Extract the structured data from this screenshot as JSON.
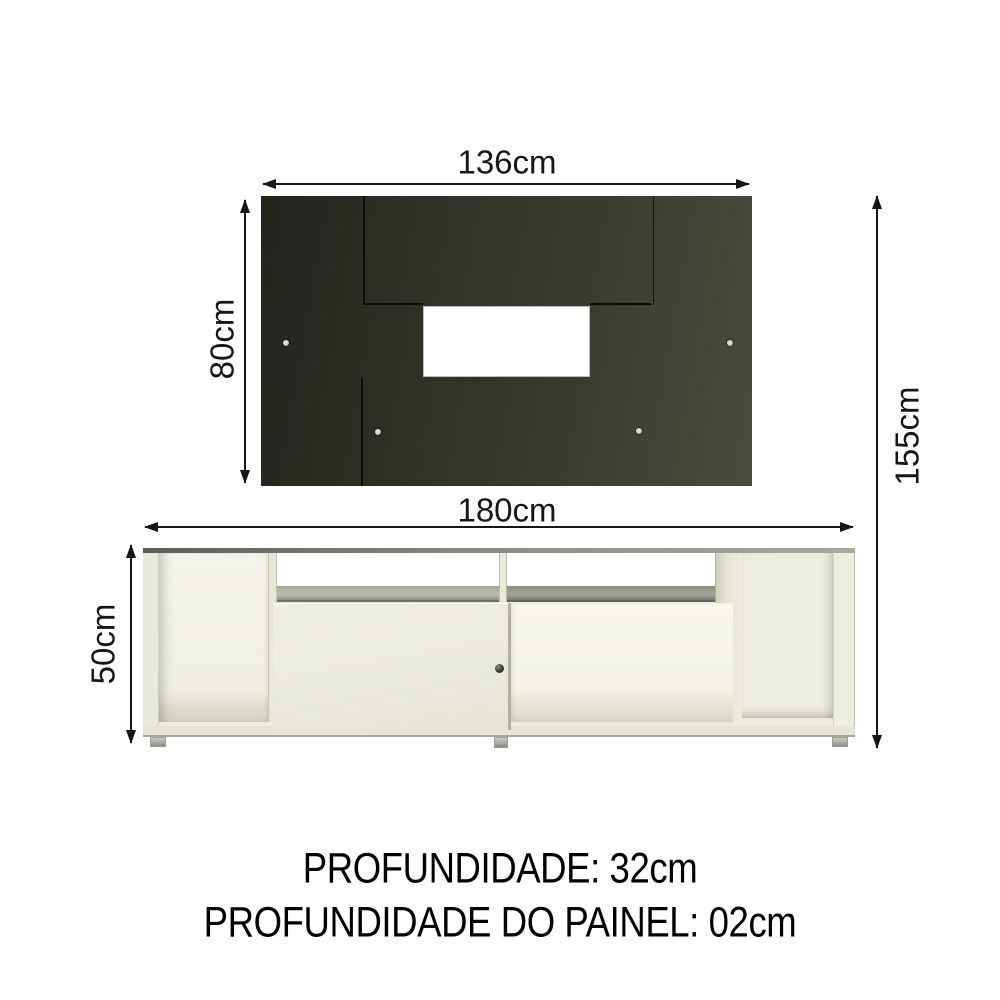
{
  "diagram": {
    "type": "furniture-dimension-diagram",
    "dimensions": {
      "panel_width": "136cm",
      "panel_height": "80cm",
      "total_height": "155cm",
      "rack_width": "180cm",
      "rack_height": "50cm"
    },
    "notes": {
      "depth": "PROFUNDIDADE: 32cm",
      "panel_depth": "PROFUNDIDADE DO PAINEL: 02cm"
    },
    "panel": {
      "screw_count": 6,
      "cutout": "tv-opening"
    },
    "colors": {
      "panel_dark": "#33342a",
      "rack_cream": "#ecebdf",
      "annotation_ink": "#161616",
      "background": "#ffffff"
    }
  }
}
